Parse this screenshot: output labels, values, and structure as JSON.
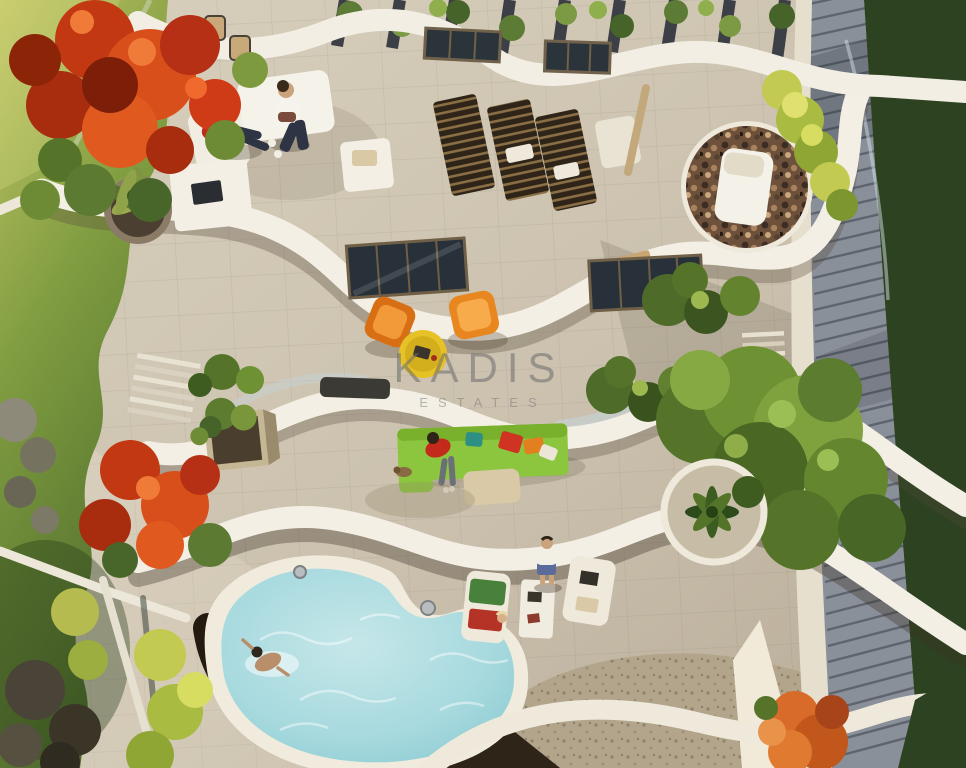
{
  "watermark": {
    "brand": "KADIS",
    "subtitle": "ESTATES"
  },
  "scene": {
    "type": "3d-architectural-render",
    "view": "aerial-top-down",
    "subject": "Multi-level modern villa with curved white terraces, rooftop pergola lounge and kidney-shaped swimming pool",
    "objects": [
      "rooftop pergola with climbing vines",
      "white outdoor lounge furniture with two people",
      "potted palm planter",
      "round mosaic sun deck with white lounger",
      "wooden slatted sun loungers",
      "glass sliding doors",
      "two orange armchairs with yellow side table",
      "lime-green garden sofa with person and dog",
      "cube planter and bench",
      "kidney-shaped pool with swimmer and chrome ladders",
      "pool-side loungers with standing person",
      "green trees over louvered roof",
      "red flowering trees on lawn",
      "pebble court",
      "louvered grey roof strip",
      "dark lawn edge"
    ]
  },
  "palette": {
    "lawn_sunlit": "#b8bf5e",
    "lawn_shaded": "#5e7c33",
    "grass_dark": "#2c4220",
    "stone_light": "#d8cfbd",
    "stone_shadow": "#a89d8a",
    "terrace_white": "#f3efe5",
    "pool_water": "#a6d9de",
    "pool_water_deep": "#84c7cf",
    "sofa_lime": "#8cc63e",
    "chair_orange": "#d96f14",
    "chair_orange_2": "#e8871f",
    "table_yellow": "#e6c226",
    "tree_red": "#c23812",
    "tree_green": "#6e9134",
    "pergola_slat": "#3d3f46",
    "roof_louver": "#8a909a",
    "mosaic_brown": "#6e513b",
    "watermark_gray": "#6c6c6c"
  }
}
